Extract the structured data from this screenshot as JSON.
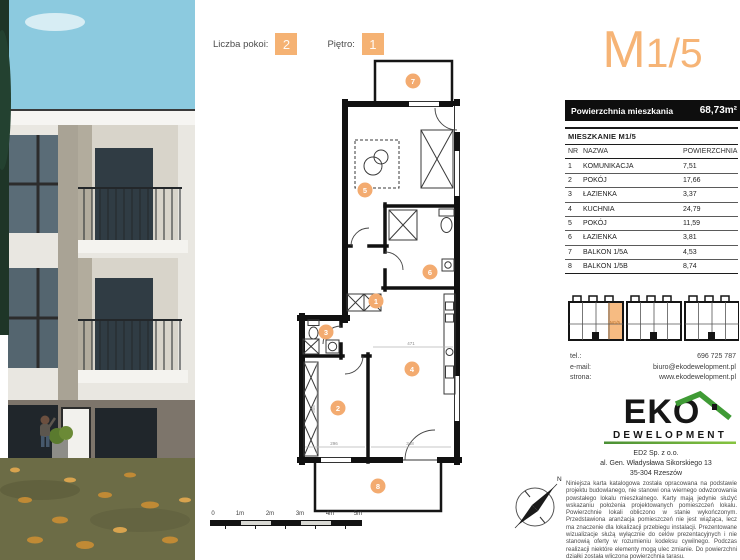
{
  "header": {
    "rooms_label": "Liczba pokoi:",
    "rooms_value": "2",
    "floor_label": "Piętro:",
    "floor_value": "1"
  },
  "unit": {
    "code_main": "M",
    "code_sub": "1/5"
  },
  "area_bar": {
    "label": "Powierzchnia mieszkania",
    "value": "68,73m²"
  },
  "table": {
    "title": "MIESZKANIE M1/5",
    "columns": [
      "NR",
      "NAZWA",
      "POWIERZCHNIA"
    ],
    "rows": [
      {
        "nr": "1",
        "name": "KOMUNIKACJA",
        "area": "7,51"
      },
      {
        "nr": "2",
        "name": "POKÓJ",
        "area": "17,66"
      },
      {
        "nr": "3",
        "name": "ŁAZIENKA",
        "area": "3,37"
      },
      {
        "nr": "4",
        "name": "KUCHNIA",
        "area": "24,79"
      },
      {
        "nr": "5",
        "name": "POKÓJ",
        "area": "11,59"
      },
      {
        "nr": "6",
        "name": "ŁAZIENKA",
        "area": "3,81"
      },
      {
        "nr": "7",
        "name": "BALKON 1/5A",
        "area": "4,53"
      },
      {
        "nr": "8",
        "name": "BALKON 1/5B",
        "area": "8,74"
      }
    ]
  },
  "plan": {
    "room_numbers": [
      "1",
      "2",
      "3",
      "4",
      "5",
      "6",
      "7",
      "8"
    ],
    "dimensions": [
      "471",
      "296",
      "348",
      "305"
    ]
  },
  "site_plan": {
    "highlight_label": "M1/5"
  },
  "contact": {
    "tel_label": "tel.:",
    "tel": "696 725 787",
    "email_label": "e-mail:",
    "email": "biuro@ekodewelopment.pl",
    "site_label": "strona:",
    "site": "www.ekodewelopment.pl"
  },
  "logo": {
    "line1": "EKO",
    "line2": "DEWELOPMENT"
  },
  "address": {
    "line1": "ED2 Sp. z o.o.",
    "line2": "al. Gen. Władysława Sikorskiego 13",
    "line3": "35-304 Rzeszów"
  },
  "disclaimer": "Niniejsza karta katalogowa została opracowana na podstawie projektu budowlanego, nie stanowi ona wiernego odwzorowania powstałego lokalu mieszkalnego. Karty mają jedynie służyć wskazaniu położenia projektowanych pomieszczeń lokalu. Powierzchnie lokali obliczono w stanie wykończonym. Przedstawiona aranżacja pomieszczeń nie jest wiążąca, lecz ma znaczenie dla lokalizacji przebiegu instalacji. Prezentowane wizualizacje służą wyłącznie do celów prezentacyjnych i nie stanowią oferty w rozumieniu kodeksu cywilnego. Podczas realizacji niektóre elementy mogą ulec zmianie. Do powierzchni działki została wliczona powierzchnia tarasu.",
  "scale": {
    "labels": [
      "0",
      "1m",
      "2m",
      "3m",
      "4m",
      "5m"
    ]
  },
  "compass": {
    "north_label": "N"
  },
  "colors": {
    "accent": "#f5b273",
    "logo_green": "#3f9b35",
    "bar_black": "#0e0e0e"
  }
}
